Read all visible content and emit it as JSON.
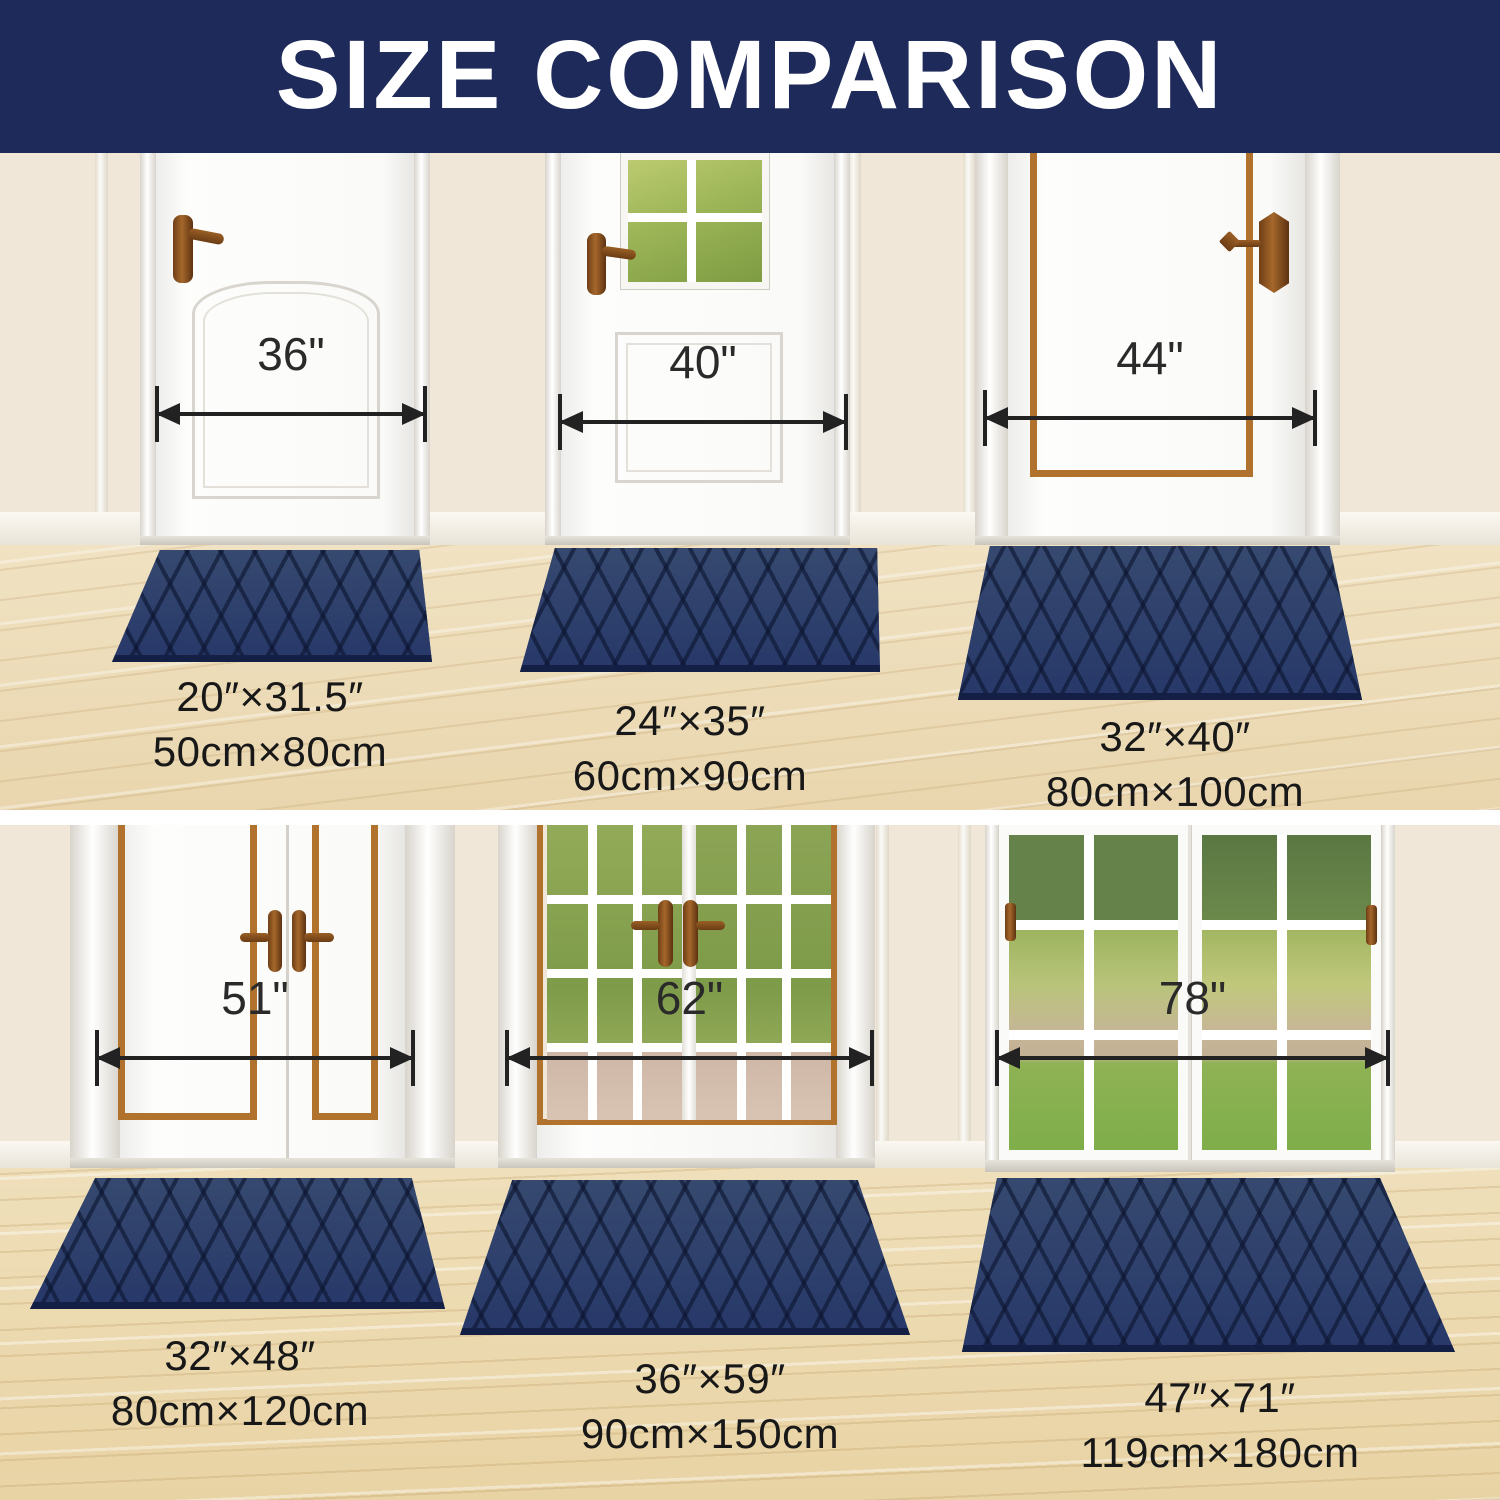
{
  "header": {
    "title": "SIZE COMPARISON"
  },
  "colors": {
    "banner_navy": "#1e2a5a",
    "mat_navy": "#2c3e6d",
    "mat_groove_navy": "#141f45",
    "wall_beige": "#f0e7d8",
    "floor_wood": "#ecdcb4",
    "copper_trim": "#b1722e",
    "measure_text": "#2a2a2a"
  },
  "top_row": {
    "doors": [
      {
        "name": "single-panel-door",
        "width_label": "36\""
      },
      {
        "name": "half-glass-door",
        "width_label": "40\""
      },
      {
        "name": "copper-trim-door",
        "width_label": "44\""
      }
    ],
    "mats": [
      {
        "inches": "20″×31.5″",
        "cm": "50cm×80cm"
      },
      {
        "inches": "24″×35″",
        "cm": "60cm×90cm"
      },
      {
        "inches": "32″×40″",
        "cm": "80cm×100cm"
      }
    ]
  },
  "bottom_row": {
    "doors": [
      {
        "name": "double-panel-door",
        "width_label": "51\""
      },
      {
        "name": "french-glass-door",
        "width_label": "62\""
      },
      {
        "name": "patio-glass-door",
        "width_label": "78\""
      }
    ],
    "mats": [
      {
        "inches": "32″×48″",
        "cm": "80cm×120cm"
      },
      {
        "inches": "36″×59″",
        "cm": "90cm×150cm"
      },
      {
        "inches": "47″×71″",
        "cm": "119cm×180cm"
      }
    ]
  }
}
